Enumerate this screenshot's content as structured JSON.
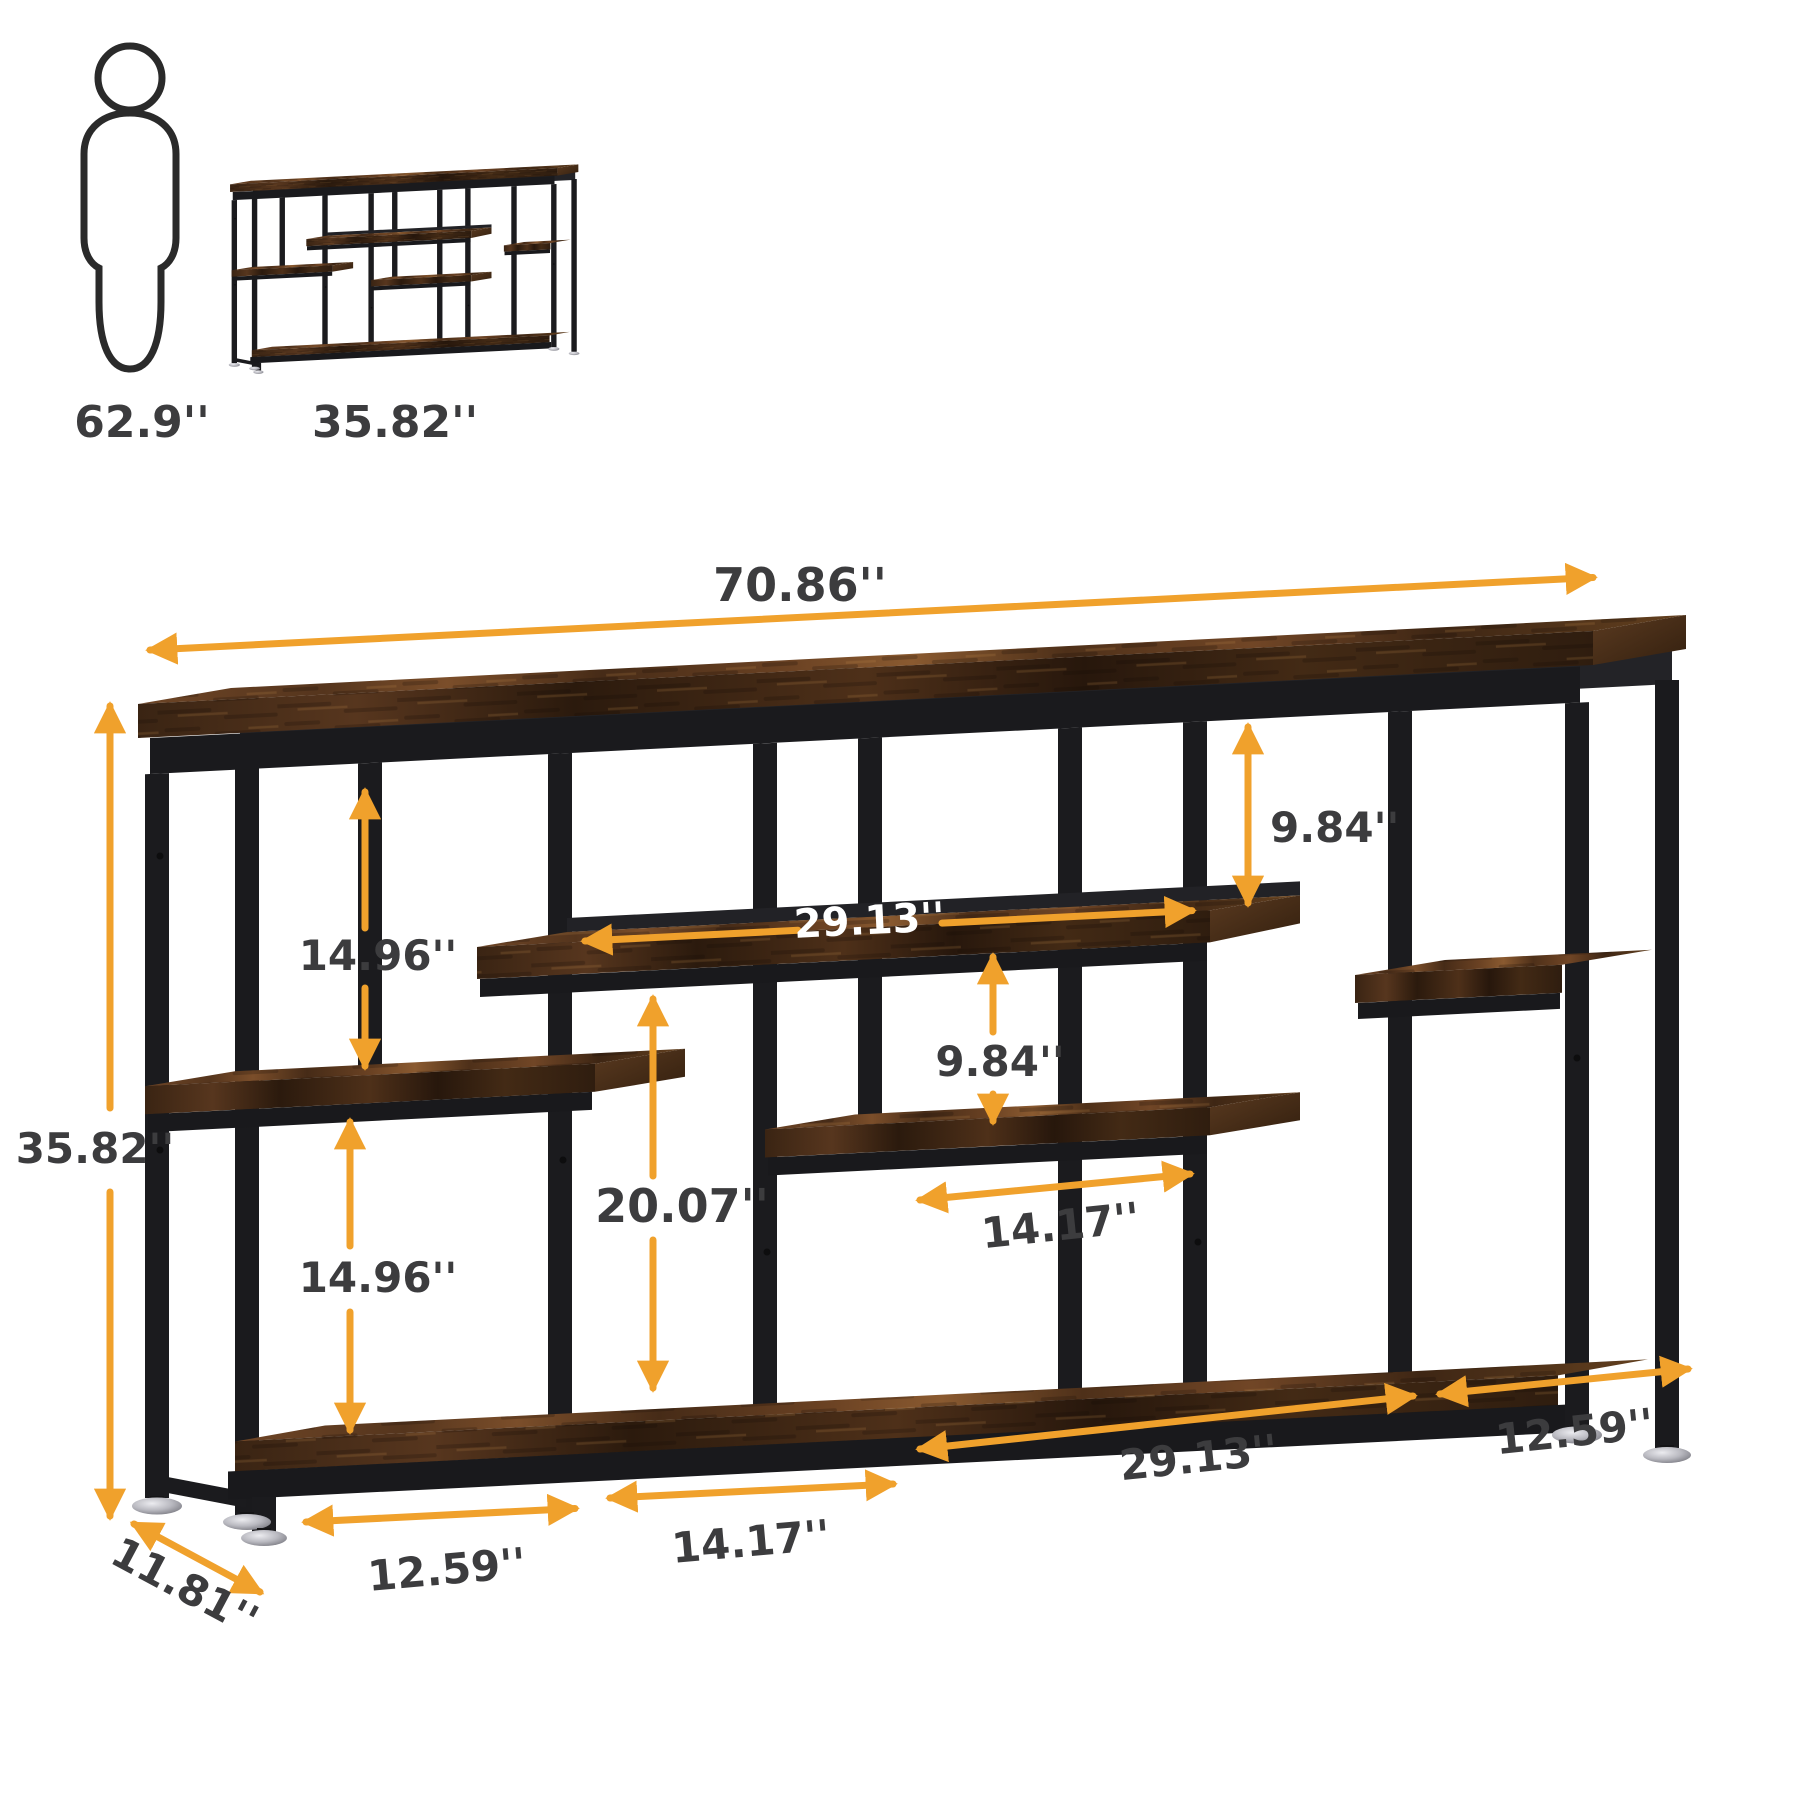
{
  "scale_reference": {
    "person_label": "62.9''",
    "product_label": "35.82''"
  },
  "product_dimensions": {
    "width": "70.86''",
    "height": "35.82''",
    "depth": "11.81''",
    "left_upper_gap": "14.96''",
    "left_lower_gap": "14.96''",
    "upper_shelf_length": "29.13''",
    "right_upper_gap": "9.84''",
    "middle_gap": "9.84''",
    "center_gap_height": "20.07''",
    "middle_shelf_length": "14.17''",
    "bottom_span_left": "12.59''",
    "bottom_span_center": "14.17''",
    "bottom_span_right_long": "29.13''",
    "bottom_span_right": "12.59''"
  },
  "colors": {
    "accent_orange": "#F0A12C",
    "label_text": "#3C3C3E",
    "frame_black": "#1B1B1E",
    "wood_brown": "#6B4423",
    "wood_dark": "#3A2413",
    "shelf_label_white": "#FFFFFF",
    "feet_silver": "#B9B9C0"
  }
}
